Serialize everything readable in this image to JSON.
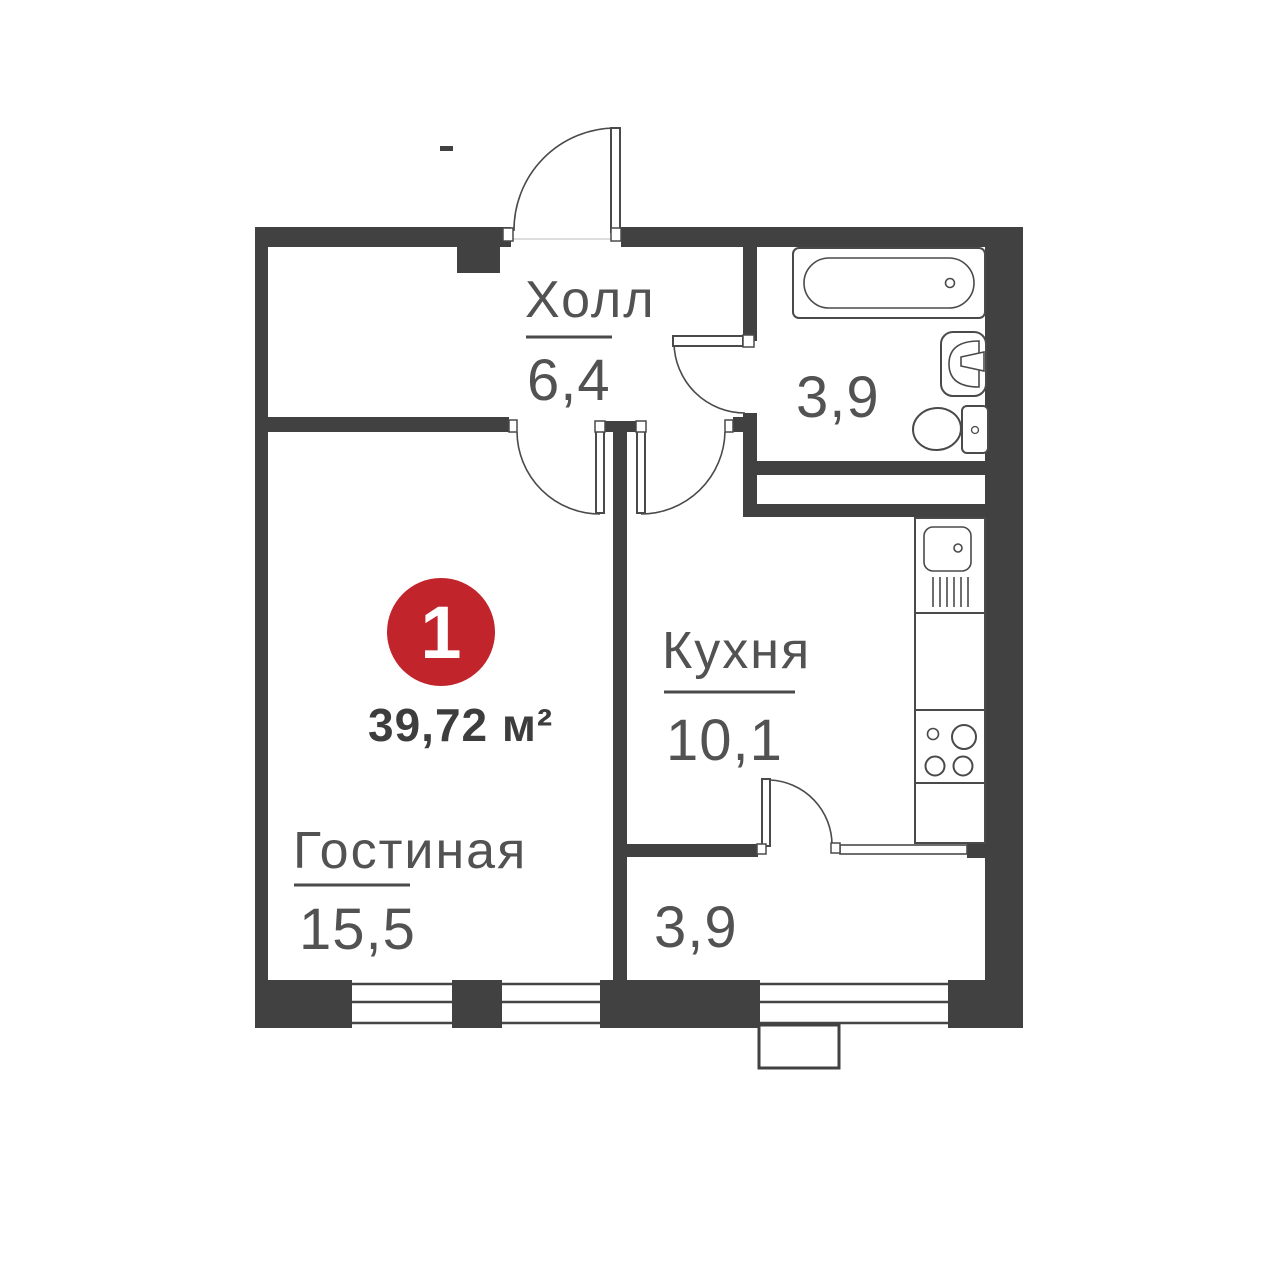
{
  "palette": {
    "wall": "#414141",
    "line": "#4a4a4a",
    "label_gray": "#525252",
    "total_gray": "#3d3d3d",
    "badge_red": "#c2242b",
    "background": "#ffffff"
  },
  "unit": {
    "badge_number": "1",
    "total_area": "39,72 м²"
  },
  "rooms": {
    "hall": {
      "name": "Холл",
      "area": "6,4"
    },
    "bathroom": {
      "name": "",
      "area": "3,9"
    },
    "kitchen": {
      "name": "Кухня",
      "area": "10,1"
    },
    "living": {
      "name": "Гостиная",
      "area": "15,5"
    },
    "corridor": {
      "name": "",
      "area": "3,9"
    }
  },
  "icons": {
    "bathtub": "bathtub-icon",
    "wash_basin": "wash-basin-icon",
    "toilet": "toilet-icon",
    "kitchen_sink": "kitchen-sink-icon",
    "stove": "stove-icon"
  }
}
